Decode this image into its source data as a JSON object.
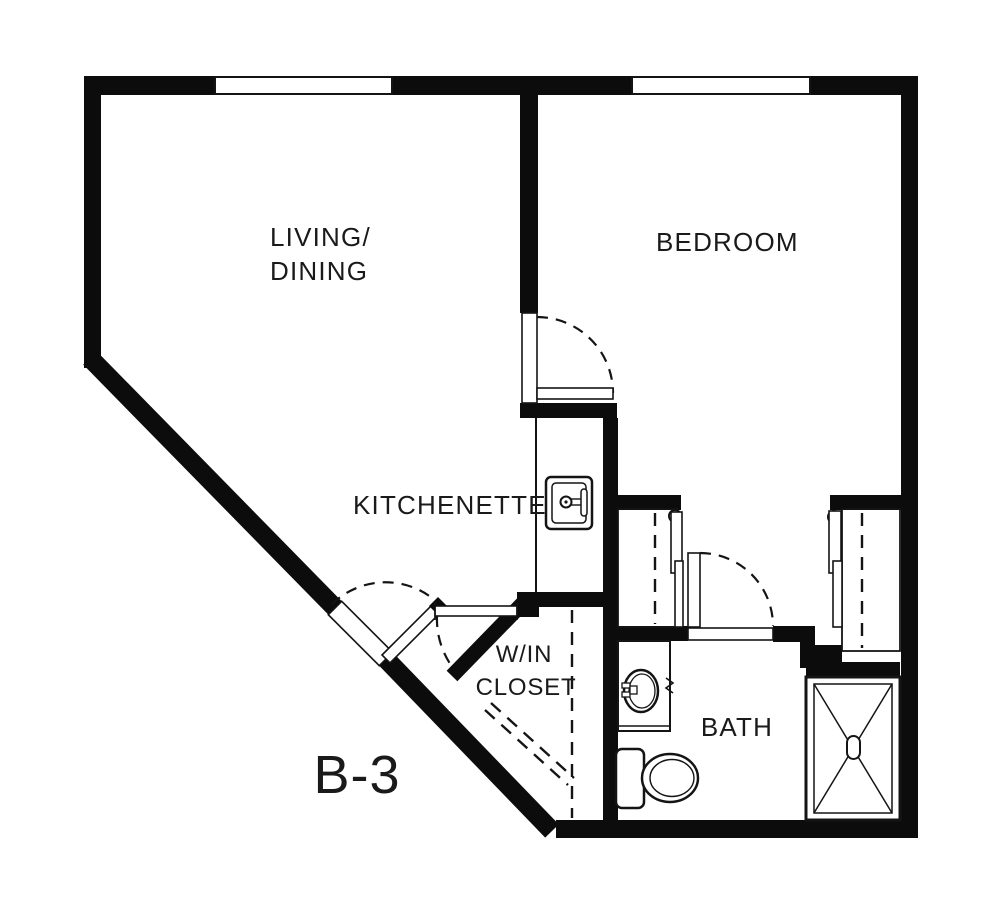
{
  "title": "Apartment floor plan",
  "unit": {
    "label": "B-3"
  },
  "rooms": {
    "living_dining": {
      "line1": "LIVING/",
      "line2": "DINING"
    },
    "bedroom": {
      "label": "BEDROOM"
    },
    "kitchenette": {
      "label": "KITCHENETTE"
    },
    "walk_in_closet": {
      "line1": "W/IN",
      "line2": "CLOSET"
    },
    "bath": {
      "label": "BATH"
    }
  },
  "fixtures": [
    {
      "name": "kitchenette-sink"
    },
    {
      "name": "bathroom-sink-vanity"
    },
    {
      "name": "toilet"
    },
    {
      "name": "shower"
    }
  ],
  "architecture": {
    "windows": 2,
    "doors": [
      {
        "name": "entry-door",
        "type": "hinged-swing"
      },
      {
        "name": "bedroom-door",
        "type": "hinged-swing"
      },
      {
        "name": "bathroom-door",
        "type": "hinged-swing"
      },
      {
        "name": "left-closet-doors",
        "type": "sliding-bypass"
      },
      {
        "name": "right-closet-doors",
        "type": "sliding-bypass"
      }
    ],
    "closet_rods": "dashed-lines"
  },
  "colors": {
    "wall": "#0c0c0c",
    "background": "#ffffff",
    "text": "#1a1a1a"
  }
}
